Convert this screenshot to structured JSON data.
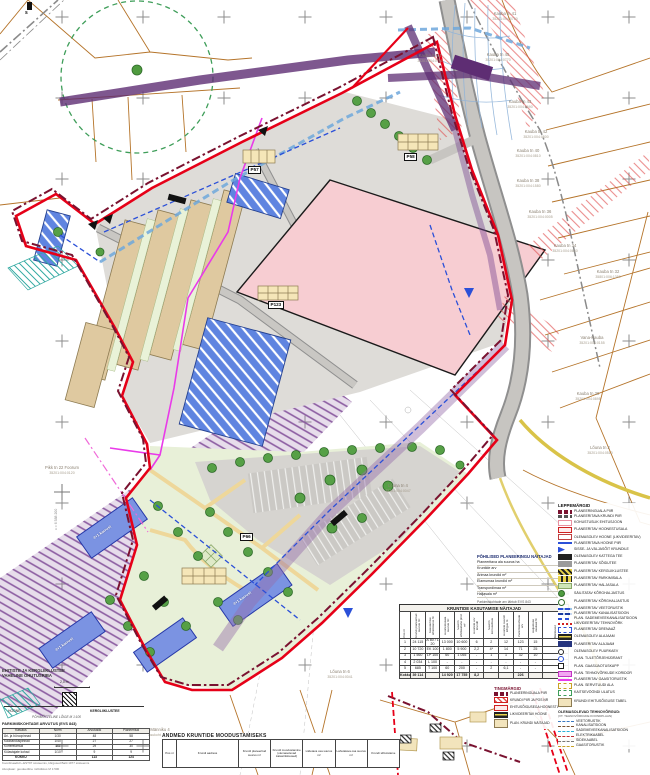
{
  "colors": {
    "boundary_red": "#e60018",
    "boundary_darkred": "#7a1230",
    "parcel_orange": "#b5742a",
    "plot_pink": "#f7cdd2",
    "building_tan": "#dfc9a0",
    "building_blue": "#7b93e2",
    "corridor_purple": "#7a4a92",
    "utility_magenta": "#e93ae9",
    "road_gray": "#c7c5c1",
    "green_zone": "#3f9e5a",
    "water_blue": "#2b50d8"
  },
  "map": {
    "corner_mark": "s",
    "coord_label": "x = 6 588 200",
    "parcel_labels": [
      {
        "x": 505,
        "y": 12,
        "name": "Kauba tn 41",
        "code": "35201:004:0760"
      },
      {
        "x": 498,
        "y": 53,
        "name": "Kauba tn 45",
        "code": "35201:004:0770"
      },
      {
        "x": 430,
        "y": 54,
        "name": "Kauba tn 44",
        "code": "35201:004:0780"
      },
      {
        "x": 520,
        "y": 100,
        "name": "Kauba tn 43",
        "code": "35201:004:0690"
      },
      {
        "x": 536,
        "y": 130,
        "name": "Kauba tn 42",
        "code": "35201:004:0800"
      },
      {
        "x": 528,
        "y": 149,
        "name": "Kauba tn 40",
        "code": "35201:004:0810"
      },
      {
        "x": 528,
        "y": 179,
        "name": "Kauba tn 38",
        "code": "35201:004:1580"
      },
      {
        "x": 540,
        "y": 210,
        "name": "Kauba tn 36",
        "code": "35201:004:0005"
      },
      {
        "x": 565,
        "y": 244,
        "name": "Kauba tn 34",
        "code": "35201:004:0640"
      },
      {
        "x": 608,
        "y": 270,
        "name": "Kauba tn 32",
        "code": "35801:006:1350"
      },
      {
        "x": 592,
        "y": 336,
        "name": "Vana-Kauba",
        "code": "35201:004:0155"
      },
      {
        "x": 588,
        "y": 392,
        "name": "Kauba tn 30",
        "code": "35201:004:0895"
      },
      {
        "x": 600,
        "y": 446,
        "name": "Lõuna tn 2",
        "code": "35201:004:0510"
      },
      {
        "x": 62,
        "y": 466,
        "name": "Pikk tn 22 Foorum",
        "code": "35201:004:0120"
      },
      {
        "x": 398,
        "y": 484,
        "name": "Lõuna tn 4",
        "code": "35201:004:0047"
      },
      {
        "x": 340,
        "y": 670,
        "name": "Lõuna tn 6",
        "code": "35201:004:0041"
      },
      {
        "x": 160,
        "y": 728,
        "name": "Männiku 4",
        "code": "asukoht 1,2 ha"
      }
    ],
    "chips": [
      {
        "x": 268,
        "y": 301,
        "label": "P123"
      },
      {
        "x": 240,
        "y": 533,
        "label": "P66"
      },
      {
        "x": 404,
        "y": 153,
        "label": "P58"
      },
      {
        "x": 248,
        "y": 166,
        "label": "P57"
      }
    ],
    "building_labels": [
      {
        "x": 92,
        "y": 536,
        "label": "4+1 korrust"
      },
      {
        "x": 232,
        "y": 602,
        "label": "4+1 korrust"
      },
      {
        "x": 54,
        "y": 648,
        "label": "4+1 korrust"
      }
    ]
  },
  "stats": {
    "title": "PÕHILISED PLANEERINGU NÄITAJAD",
    "rows": [
      {
        "label": "Planeeritava ala suurus ha",
        "value": "4,2"
      },
      {
        "label": "Kruntide arv",
        "value": "5"
      },
      {
        "label": "Ärimaa krundid m²",
        "value": "24 945"
      },
      {
        "label": "Elamumaa krundid m²",
        "value": "10 720"
      },
      {
        "label": "Transpordimaa m²",
        "value": "2 719"
      },
      {
        "label": "Haljasala m²",
        "value": "1 650"
      }
    ],
    "footnote": "Parkimiskohtade arv lähtub EVS 843"
  },
  "usage_table": {
    "title": "KRUNTIDE KASUTAMISE NÄITAJAD",
    "col_headers": [
      "Pos nr",
      "Krundi planeeritud suurus m²",
      "Kasutamise sihtotstarve %",
      "Hoonestusala suurus m²",
      "Suurim ehitisealune pind m²",
      "Hoonete arv krundil",
      "Suurim korruselisus",
      "Hoonete suurim kõrgus m",
      "Parkimiskohtade arv",
      "Haljastuse osakaal %",
      "Märkused"
    ],
    "rows": [
      [
        "1",
        "24 115",
        "Ä 80 / L 20",
        "13 000",
        "10 600",
        "6",
        "2",
        "12",
        "123",
        "15",
        ""
      ],
      [
        "2",
        "10 720",
        "EK 100",
        "1 800",
        "5 900",
        "2,2",
        "4*",
        "14",
        "71",
        "25",
        ""
      ],
      [
        "3",
        "1 560",
        "LP 100",
        "60",
        "1 055",
        "-",
        "1",
        "1",
        "32",
        "10",
        ""
      ],
      [
        "4",
        "2 034",
        "L 100",
        "-",
        "-",
        "-",
        "-",
        "-",
        "-",
        "-",
        ""
      ],
      [
        "5",
        "685",
        "T 100",
        "60",
        "200",
        "-",
        "2",
        "6,1",
        "-",
        "-",
        ""
      ]
    ],
    "total": [
      "Kokku",
      "39 114",
      "",
      "14 920",
      "17 755",
      "8,2",
      "",
      "",
      "226",
      "",
      ""
    ]
  },
  "formation_table": {
    "title": "ANDMED KRUNTIDE MOODUSTAMISEKS",
    "col_headers": [
      "Pos nr",
      "Krundi aadress",
      "Krundi planeeritud suurus m²",
      "Krundi moodustamine (olemasolevad katastriüksused)",
      "Liidetava osa suurus m²",
      "Lahutatava osa suurus m²",
      "Krundi sihtotstarve"
    ]
  },
  "tingmargid": {
    "title": "TINGMÄRGID",
    "items": [
      {
        "kind": "darkred-pair",
        "label": "PLANEERINGUALA PIIR"
      },
      {
        "kind": "redhatch-rect",
        "label": "KRUNDI PIIR JA POS NR"
      },
      {
        "kind": "red-rect",
        "label": "EHITUSÕIGUSEGA HOONESTUSALA"
      },
      {
        "kind": "stripe-rect",
        "label": "LIKVIDEERITAV HOONE"
      },
      {
        "kind": "beige-chip",
        "label": "PLAN. KRUNDI NÄITAJAD"
      }
    ]
  },
  "legend": {
    "title": "LEPPEMÄRGID",
    "items": [
      {
        "kind": "darkred-pair",
        "label": "PLANEERINGUALA PIIR"
      },
      {
        "kind": "gray-pair",
        "label": "PLANEERITAVA KRUNDI PIIR"
      },
      {
        "kind": "pink-bracket",
        "label": "KOHUSTUSLIK EHITUSJOON"
      },
      {
        "kind": "red-rect",
        "label": "PLANEERITAV HOONESTUSALA"
      },
      {
        "kind": "redline-rect",
        "label": "OLEMASOLEV HOONE (LIKVIDEERITAV)"
      },
      {
        "kind": "blue-line",
        "label": "PLANEERITAVA HOONE PIIR"
      },
      {
        "kind": "blue-flag",
        "label": "SISSE- JA VÄLJASÕIT KRUNDILE"
      },
      {
        "kind": "black-bar",
        "label": "OLEMASOLEV KATTEGA TEE"
      },
      {
        "kind": "gray-bar",
        "label": "PLANEERITAV SÕIDUTEE"
      },
      {
        "kind": "yhatch",
        "label": "PLANEERITAV KERGLIIKLUSTEE"
      },
      {
        "kind": "yhatch2",
        "label": "PLANEERITAV PARKIMISALA"
      },
      {
        "kind": "gdots",
        "label": "PLANEERITAV HALJASALA"
      },
      {
        "kind": "tree",
        "label": "SÄILITATAV KÕRGHALJASTUS"
      },
      {
        "kind": "tree2",
        "label": "PLANEERITAV KÕRGHALJASTUS"
      },
      {
        "kind": "bwave",
        "label": "PLANEERITAV VEETORUSTIK"
      },
      {
        "kind": "bwave2",
        "label": "PLANEERITAV KANALISATSIOON"
      },
      {
        "kind": "bdash",
        "label": "PLAN. SADEMEVEEKANALISATSIOON"
      },
      {
        "kind": "reddot",
        "label": "LIKVIDEERITAV TEHNOVÕRK"
      },
      {
        "kind": "bdrect",
        "label": "PLANEERITAV DRENAAŽ"
      },
      {
        "kind": "stripe-rect",
        "label": "OLEMASOLEV ALAJAAM"
      },
      {
        "kind": "dkblue-rect",
        "label": "PLANEERITAV ALAJAAM"
      },
      {
        "kind": "circ",
        "label": "OLEMASOLEV PUURKAEV"
      },
      {
        "kind": "circ2",
        "label": "PLAN. TULETÕRJEHÜDRANT"
      },
      {
        "kind": "sq",
        "label": "PLAN. GAASIJAOTUSKAPP"
      },
      {
        "kind": "mag-rect",
        "label": "PLAN. TEHNOVÕRKUDE KORIDOR"
      },
      {
        "kind": "mag-line",
        "label": "PLANEERITAV GAASITORUSTIK"
      },
      {
        "kind": "ydash-rect",
        "label": "PLAN. SERVITUUDI ALA"
      },
      {
        "kind": "gdash-rect",
        "label": "KAITSEVÖÖNDI ULATUS"
      },
      {
        "kind": "beige-chip",
        "label": "KRUNDI EHITUSÕIGUSE TABEL"
      }
    ],
    "lines_title": "OLEMASOLEVAD TEHNOVÕRGUD:",
    "lines_sub": "(VT. TEHNOVÕRKUDE KOONDPLAAN)",
    "line_items": [
      {
        "kind": "ln1",
        "label": "VEETORUSTIK"
      },
      {
        "kind": "ln2",
        "label": "KANALISATSIOON"
      },
      {
        "kind": "ln3",
        "label": "SADEMEVEEKANALISATSIOON"
      },
      {
        "kind": "ln4",
        "label": "ELEKTRIKAABEL"
      },
      {
        "kind": "ln5",
        "label": "SIDEKAABEL"
      },
      {
        "kind": "ln6",
        "label": "GAASITORUSTIK"
      }
    ]
  },
  "safety_note": {
    "title1": "EHITISTE JA KERGLIIKLUSTEE",
    "title2": "VAHELINE OHUTUSRIBA",
    "dim": "2,0 m",
    "left": "HOONE",
    "right": "KERGLIIKLUSTEE",
    "caption": "PÕHIMÕTTELINE LÕIGE M 1:100"
  },
  "parking_table": {
    "title": "PARKIMISKOHTADE ARVUTUS (EVS 843)",
    "col_headers": [
      "Kasutus",
      "Norm",
      "Arvutuslik",
      "Planeeritud"
    ],
    "rows": [
      [
        "Äri- ja büroopinnad",
        "1/30",
        "48",
        "58"
      ],
      [
        "Kaubanduspinnad",
        "1/40",
        "27",
        "27"
      ],
      [
        "Korterelamud",
        "1/1",
        "29",
        "30"
      ],
      [
        "Külastajate kohad",
        "1/10",
        "9",
        "9"
      ]
    ],
    "total": [
      "KOKKU",
      "",
      "113",
      "124"
    ]
  },
  "base_notes": [
    "Koordinaadid L-EST97 süsteemis, kõrgused Balti 1977 süsteemis",
    "Alusplaan: geodeetiline mõõdistus M 1:500"
  ]
}
